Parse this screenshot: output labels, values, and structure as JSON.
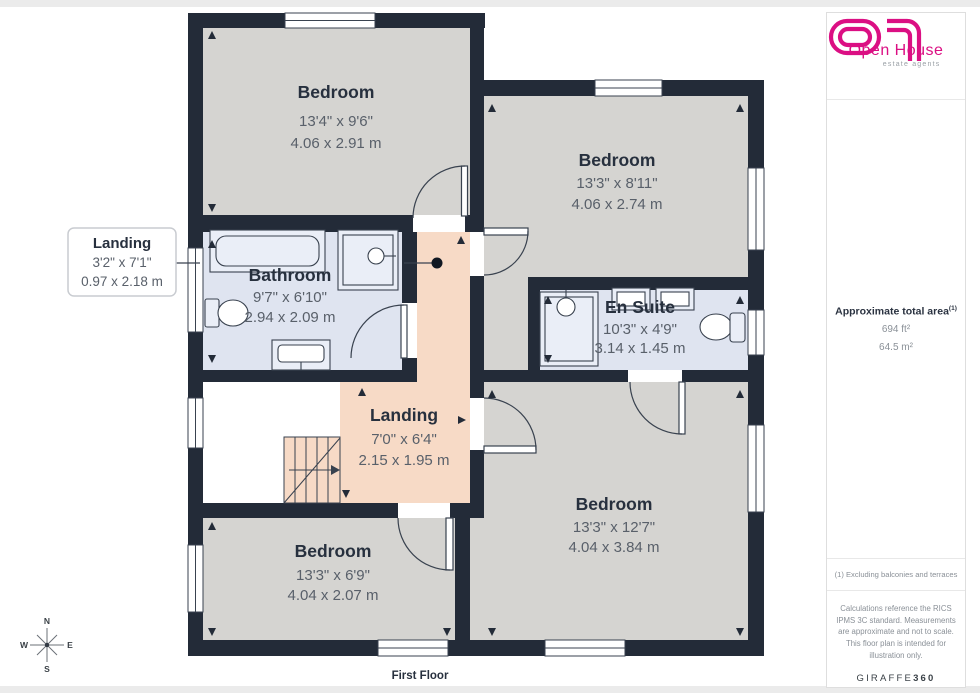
{
  "page": {
    "floor_label": "First Floor"
  },
  "plan": {
    "rooms": [
      {
        "name": "Bedroom",
        "imperial": "13'4\" x 9'6\"",
        "metric": "4.06 x 2.91 m"
      },
      {
        "name": "Bedroom",
        "imperial": "13'3\" x 8'11\"",
        "metric": "4.06 x 2.74 m"
      },
      {
        "name": "Bathroom",
        "imperial": "9'7\" x 6'10\"",
        "metric": "2.94 x 2.09 m"
      },
      {
        "name": "En Suite",
        "imperial": "10'3\" x 4'9\"",
        "metric": "3.14 x 1.45 m"
      },
      {
        "name": "Landing",
        "imperial": "7'0\" x 6'4\"",
        "metric": "2.15 x 1.95 m"
      },
      {
        "name": "Bedroom",
        "imperial": "13'3\" x 6'9\"",
        "metric": "4.04 x 2.07 m"
      },
      {
        "name": "Bedroom",
        "imperial": "13'3\" x 12'7\"",
        "metric": "4.04 x 3.84 m"
      }
    ],
    "callout": {
      "name": "Landing",
      "imperial": "3'2\" x 7'1\"",
      "metric": "0.97 x 2.18 m"
    },
    "compass": {
      "n": "N",
      "e": "E",
      "s": "S",
      "w": "W"
    }
  },
  "sidebar": {
    "logo": {
      "brand": "Open House",
      "tagline": "estate agents"
    },
    "area": {
      "title": "Approximate total area",
      "note_ref": "(1)",
      "imperial": "694 ft²",
      "metric": "64.5 m²"
    },
    "footnote": "(1) Excluding balconies and terraces",
    "disclaimer": "Calculations reference the RICS IPMS 3C standard. Measurements are approximate and not to scale. This floor plan is intended for illustration only.",
    "brand": {
      "name": "GIRAFFE",
      "number": "360"
    }
  },
  "colors": {
    "wall": "#232B38",
    "bedroom_fill": "#D5D4D1",
    "bath_fill": "#DFE4F0",
    "landing_fill": "#F7DAC6",
    "logo_magenta": "#DB0F83"
  }
}
